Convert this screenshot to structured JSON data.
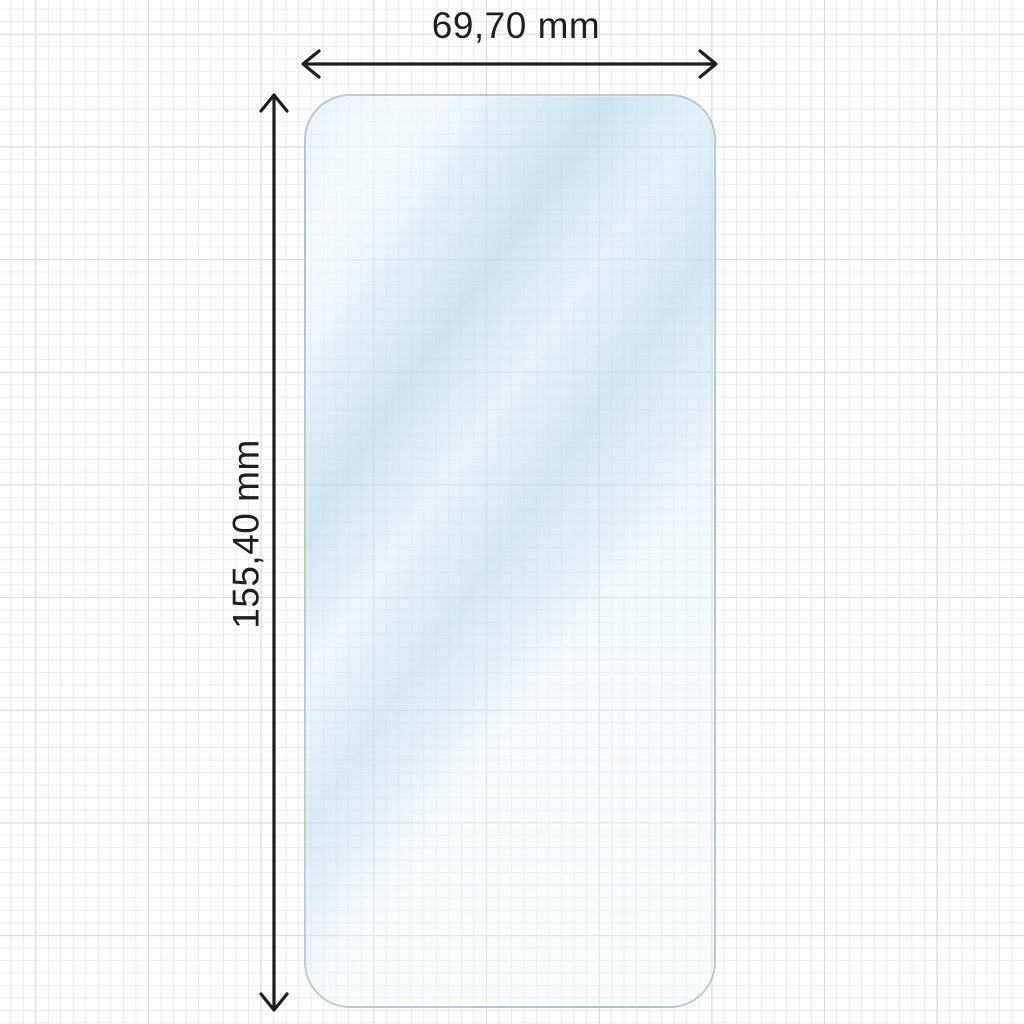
{
  "dimensions": {
    "width": {
      "label": "69,70 mm",
      "value": "69,70",
      "unit": "mm"
    },
    "height": {
      "label": "155,40 mm",
      "value": "155,40",
      "unit": "mm"
    }
  },
  "colors": {
    "annotation_line": "#1e1e1c",
    "label_text": "#1e1e1c",
    "protector_fill": "#ddeef6",
    "protector_edge": "#92b2b4",
    "grid_minor": "#ececec",
    "grid_major": "#d8d8d8",
    "background": "#ffffff"
  }
}
